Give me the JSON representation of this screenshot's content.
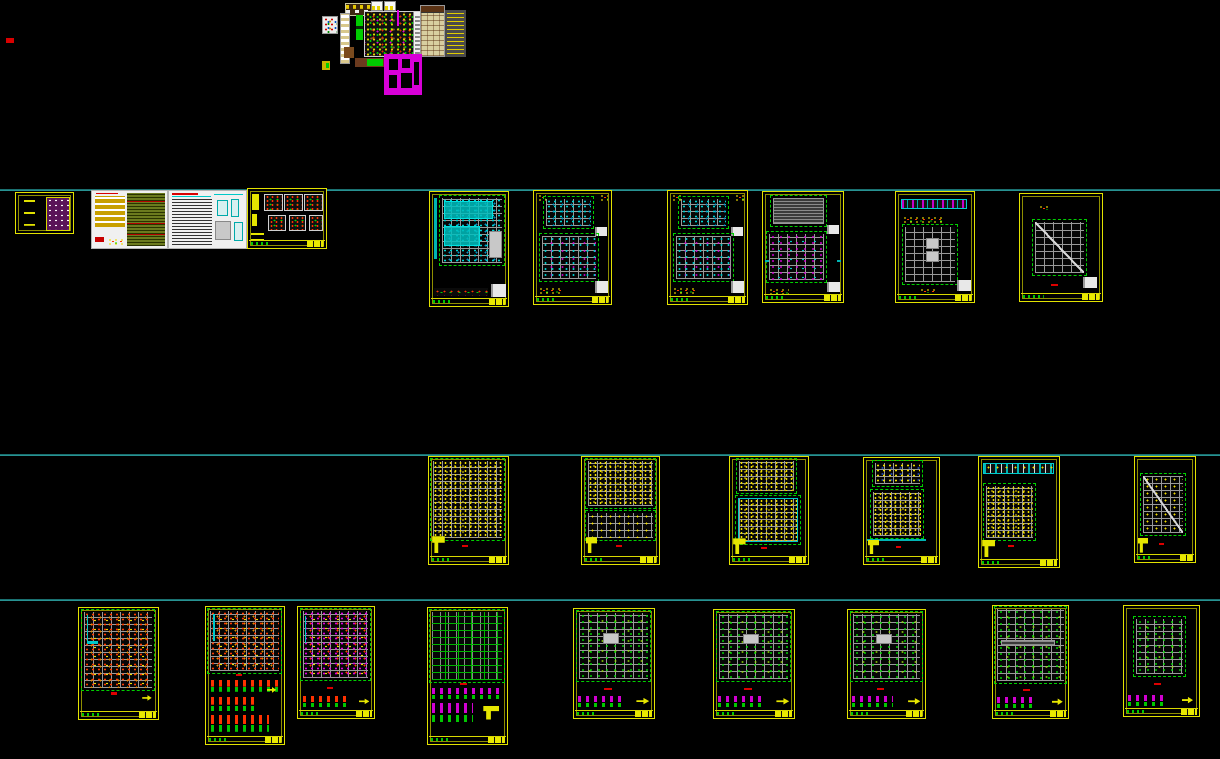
{
  "canvas": {
    "width": 1220,
    "height": 759,
    "background": "#000000"
  },
  "palette": {
    "sheet_border": "#e2e200",
    "guide_line": "#2f9f9f",
    "grid_gray": "#9a9a9a",
    "accent_cyan": "#00c8c8",
    "accent_green": "#00d000",
    "accent_yellow": "#e6d200",
    "accent_red": "#e03200",
    "accent_magenta": "#d800d8",
    "paper_white": "#f0f0f0"
  },
  "guide_lines": [
    {
      "name": "layout-guide-line-1",
      "y": 189
    },
    {
      "name": "layout-guide-line-2",
      "y": 454
    },
    {
      "name": "layout-guide-line-3",
      "y": 599
    }
  ],
  "markers": [
    {
      "name": "red-marker",
      "kind": "red",
      "x": 6,
      "y": 38,
      "w": 8,
      "h": 5
    }
  ],
  "cluster": {
    "name": "title-block-cluster",
    "blocks": [
      {
        "name": "legend-table-brown",
        "kind": "table-brown",
        "x": 345,
        "y": 3,
        "w": 30,
        "h": 11
      },
      {
        "name": "mini-table-a",
        "kind": "mini-table",
        "x": 371,
        "y": 1,
        "w": 10,
        "h": 8
      },
      {
        "name": "mini-table-b",
        "kind": "mini-table",
        "x": 384,
        "y": 1,
        "w": 10,
        "h": 8
      },
      {
        "name": "color-swatch-table",
        "kind": "swatch",
        "x": 322,
        "y": 16,
        "w": 14,
        "h": 16
      },
      {
        "name": "schedule-strip",
        "kind": "strip-rows",
        "x": 340,
        "y": 13,
        "w": 8,
        "h": 49
      },
      {
        "name": "green-bar",
        "kind": "green-bar",
        "x": 356,
        "y": 15,
        "w": 7,
        "h": 25
      },
      {
        "name": "site-plan-block",
        "kind": "site-plan",
        "x": 364,
        "y": 11,
        "w": 56,
        "h": 44
      },
      {
        "name": "magenta-tick",
        "kind": "magenta-tick",
        "x": 397,
        "y": 10,
        "w": 2,
        "h": 16
      },
      {
        "name": "material-table",
        "kind": "table-tan",
        "x": 420,
        "y": 5,
        "w": 23,
        "h": 50
      },
      {
        "name": "notes-panel-gray",
        "kind": "notes-gray",
        "x": 445,
        "y": 10,
        "w": 21,
        "h": 47
      },
      {
        "name": "bracket-piece",
        "kind": "brown-piece",
        "x": 344,
        "y": 47,
        "w": 10,
        "h": 11
      },
      {
        "name": "equipment-bar",
        "kind": "brown-green-bar",
        "x": 355,
        "y": 58,
        "w": 34,
        "h": 9
      },
      {
        "name": "small-flag-piece",
        "kind": "yellow-green-piece",
        "x": 322,
        "y": 61,
        "w": 8,
        "h": 9
      },
      {
        "name": "floor-plan-magenta",
        "kind": "magenta-plan",
        "x": 384,
        "y": 54,
        "w": 38,
        "h": 41
      }
    ]
  },
  "sheet_groups": [
    {
      "name": "cover-and-notes-row",
      "sheets": [
        {
          "name": "sheet-cover",
          "variant": "tiny-purple",
          "x": 15,
          "y": 192,
          "w": 57,
          "h": 40
        },
        {
          "name": "sheet-general-notes-1",
          "variant": "notes-a",
          "x": 91,
          "y": 190,
          "w": 75,
          "h": 57
        },
        {
          "name": "sheet-general-notes-2",
          "variant": "notes-b",
          "x": 168,
          "y": 190,
          "w": 77,
          "h": 57
        },
        {
          "name": "sheet-standard-details",
          "variant": "details-black",
          "x": 247,
          "y": 188,
          "w": 78,
          "h": 59
        }
      ]
    },
    {
      "name": "framing-plans-row",
      "sheets": [
        {
          "name": "sheet-foundation-plan",
          "variant": "plan-cyan",
          "x": 429,
          "y": 191,
          "w": 78,
          "h": 114
        },
        {
          "name": "sheet-framing-plan-1",
          "variant": "framing-2",
          "x": 533,
          "y": 190,
          "w": 77,
          "h": 113
        },
        {
          "name": "sheet-framing-plan-2",
          "variant": "framing-2",
          "x": 667,
          "y": 190,
          "w": 79,
          "h": 113
        },
        {
          "name": "sheet-framing-plan-3",
          "variant": "framing-2b",
          "x": 762,
          "y": 191,
          "w": 80,
          "h": 110
        },
        {
          "name": "sheet-beam-elevation",
          "variant": "beam-plan",
          "x": 895,
          "y": 191,
          "w": 78,
          "h": 110
        },
        {
          "name": "sheet-roof-plan",
          "variant": "single-plan",
          "x": 1019,
          "y": 193,
          "w": 82,
          "h": 107
        }
      ]
    },
    {
      "name": "beam-reinforcement-row",
      "sheets": [
        {
          "name": "sheet-rebar-plan-1",
          "variant": "rebar-full",
          "x": 428,
          "y": 456,
          "w": 79,
          "h": 107
        },
        {
          "name": "sheet-rebar-plan-2",
          "variant": "rebar-top",
          "x": 581,
          "y": 456,
          "w": 77,
          "h": 107
        },
        {
          "name": "sheet-rebar-plan-3",
          "variant": "rebar-2",
          "x": 729,
          "y": 456,
          "w": 78,
          "h": 107
        },
        {
          "name": "sheet-rebar-plan-4",
          "variant": "rebar-beam",
          "x": 863,
          "y": 457,
          "w": 75,
          "h": 106
        },
        {
          "name": "sheet-rebar-plan-5",
          "variant": "beam-rebar",
          "x": 978,
          "y": 456,
          "w": 80,
          "h": 110
        },
        {
          "name": "sheet-rebar-plan-6",
          "variant": "single-sparse",
          "x": 1134,
          "y": 456,
          "w": 60,
          "h": 105
        }
      ]
    },
    {
      "name": "column-wall-plans-row",
      "sheets": [
        {
          "name": "sheet-column-plan-1",
          "variant": "col-red",
          "x": 78,
          "y": 607,
          "w": 79,
          "h": 111
        },
        {
          "name": "sheet-column-plan-2",
          "variant": "col-red-details",
          "x": 205,
          "y": 606,
          "w": 78,
          "h": 137
        },
        {
          "name": "sheet-column-plan-3",
          "variant": "col-magenta",
          "x": 297,
          "y": 606,
          "w": 76,
          "h": 111
        },
        {
          "name": "sheet-wall-plan-1",
          "variant": "wall-green-details",
          "x": 427,
          "y": 607,
          "w": 79,
          "h": 136
        },
        {
          "name": "sheet-wall-plan-2",
          "variant": "wall-details",
          "x": 573,
          "y": 608,
          "w": 80,
          "h": 109
        },
        {
          "name": "sheet-wall-plan-3",
          "variant": "wall-details",
          "x": 713,
          "y": 609,
          "w": 80,
          "h": 108
        },
        {
          "name": "sheet-wall-plan-4",
          "variant": "wall-details",
          "x": 847,
          "y": 609,
          "w": 77,
          "h": 108
        },
        {
          "name": "sheet-wall-plan-5",
          "variant": "wall-details-full",
          "x": 992,
          "y": 605,
          "w": 75,
          "h": 112
        },
        {
          "name": "sheet-wall-plan-6",
          "variant": "wall-small",
          "x": 1123,
          "y": 605,
          "w": 75,
          "h": 110
        }
      ]
    }
  ]
}
